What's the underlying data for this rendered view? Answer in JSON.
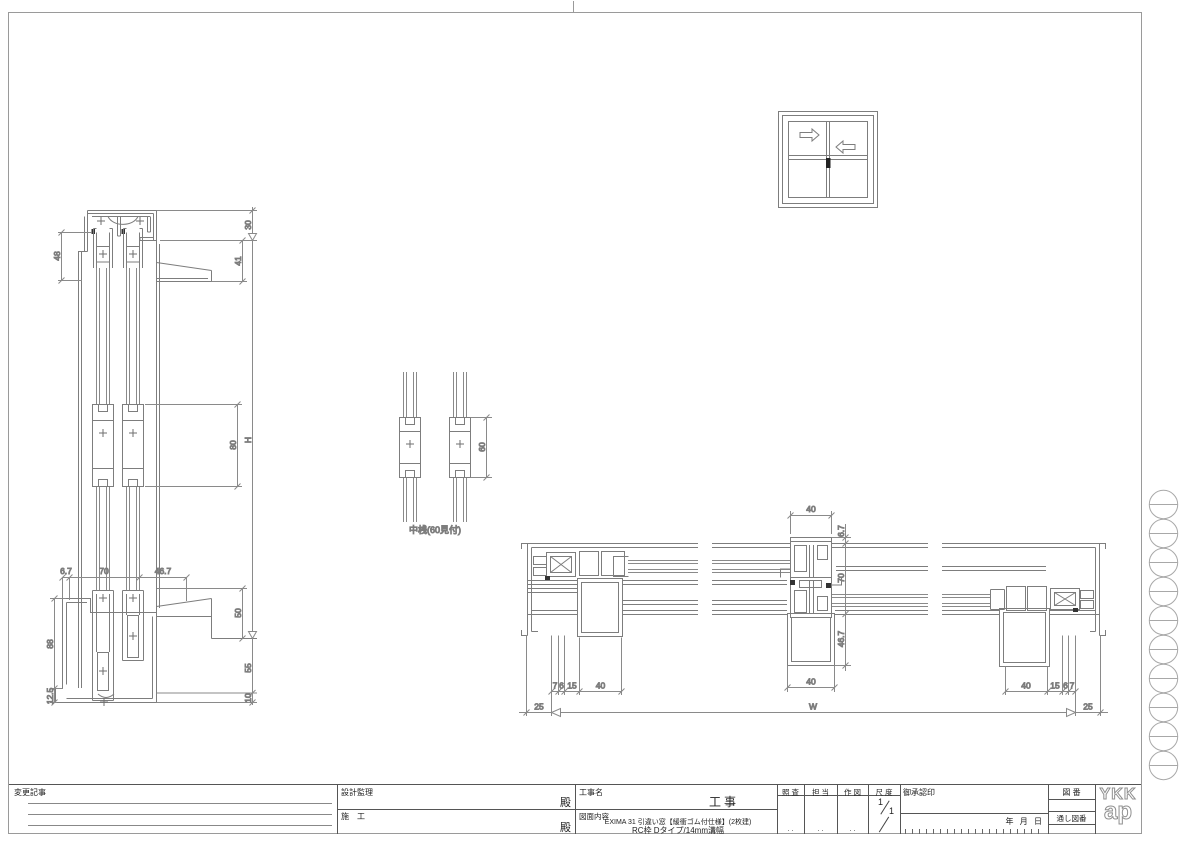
{
  "dims": {
    "vs_48": "48",
    "vs_30": "30",
    "vs_41": "41",
    "vs_80": "80",
    "vs_h": "H",
    "vs_6_7": "6.7",
    "vs_70": "70",
    "vs_46_7": "46.7",
    "vs_88": "88",
    "vs_12_5": "12.5",
    "vs_50": "50",
    "vs_55": "55",
    "vs_10": "10",
    "md_60": "60",
    "hs_40_top": "40",
    "hs_6_7": "6.7",
    "hs_70": "70",
    "hs_46_7": "46.7",
    "hs_40_bottom": "40",
    "hs_7_l": "7",
    "hs_6_l": "6",
    "hs_15_l": "15",
    "hs_40_l": "40",
    "hs_40_r": "40",
    "hs_15_r": "15",
    "hs_6_r": "6",
    "hs_7_r": "7",
    "hs_25_l": "25",
    "hs_w": "W",
    "hs_25_r": "25"
  },
  "labels": {
    "mullion_caption": "中桟(60見付)"
  },
  "title_block": {
    "change_notes": "変更記事",
    "design_supervision": "設計監理",
    "construction": "施　工",
    "dono_1": "殿",
    "dono_2": "殿",
    "project_label": "工事名",
    "project_suffix": "工事",
    "content_label": "図面内容",
    "content_line1": "EXIMA 31 引違い窓【緩衝ゴム付仕様】(2枚建)",
    "content_line2": "RC枠 Dタイプ/14mm溝幅",
    "check": "照 査",
    "charge": "担 当",
    "draft": "作 図",
    "scale": "尺 度",
    "scale_num": "1",
    "scale_den": "1",
    "approval": "御承認印",
    "date": "年 月 日",
    "placeholder_dots": ". .",
    "drawing_no": "図 番",
    "serial_no": "通し図番",
    "logo_top": "YKK",
    "logo_bottom": "ap"
  }
}
